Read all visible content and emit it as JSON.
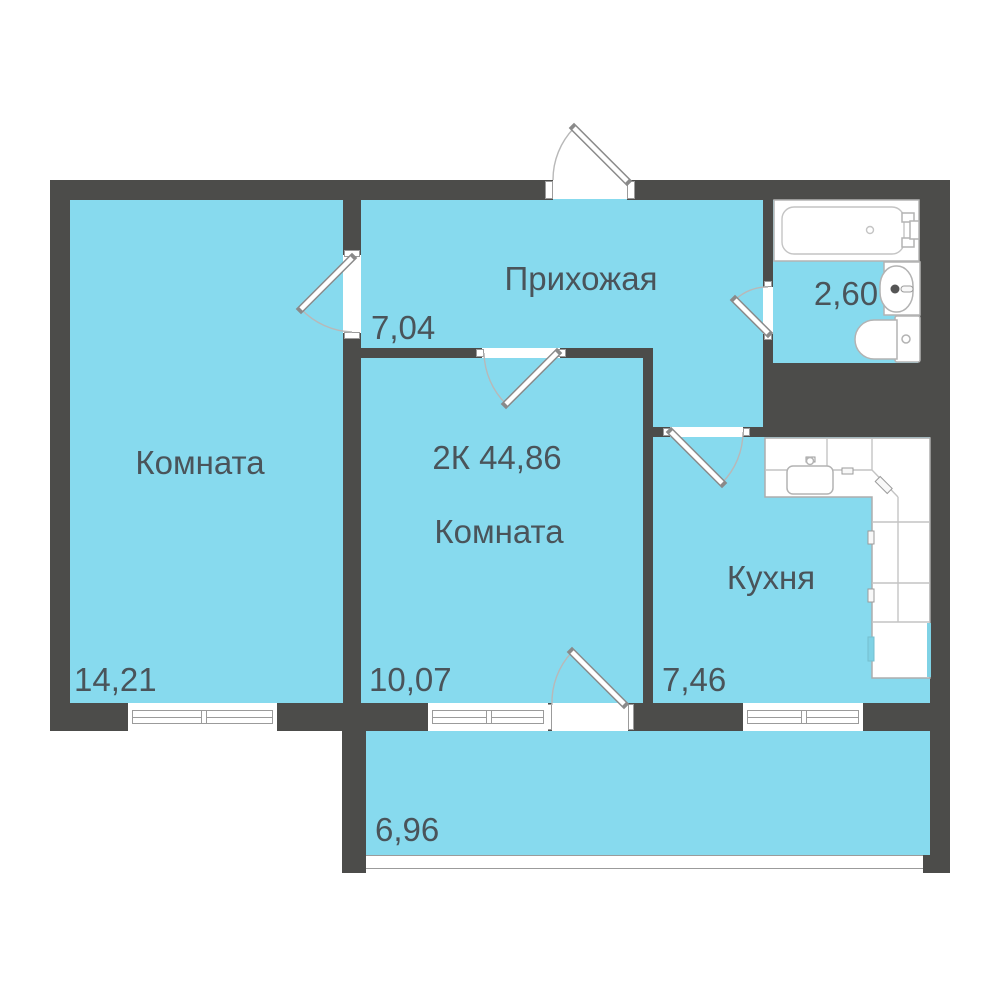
{
  "title": "2К 44,86",
  "rooms": {
    "living1": {
      "name": "Комната",
      "area": "14,21"
    },
    "hallway": {
      "name": "Прихожая",
      "area": "7,04"
    },
    "bathroom": {
      "area": "2,60"
    },
    "living2": {
      "name": "Комната",
      "area": "10,07"
    },
    "kitchen": {
      "name": "Кухня",
      "area": "7,46"
    },
    "balcony": {
      "area": "6,96"
    }
  },
  "colors": {
    "wall": "#4c4c4a",
    "floor": "#87daee",
    "text": "#4a545a",
    "frame_line": "#9b9b9b",
    "fixture_line": "#b3b3b3",
    "accent_teal": "#7fd2e5"
  }
}
